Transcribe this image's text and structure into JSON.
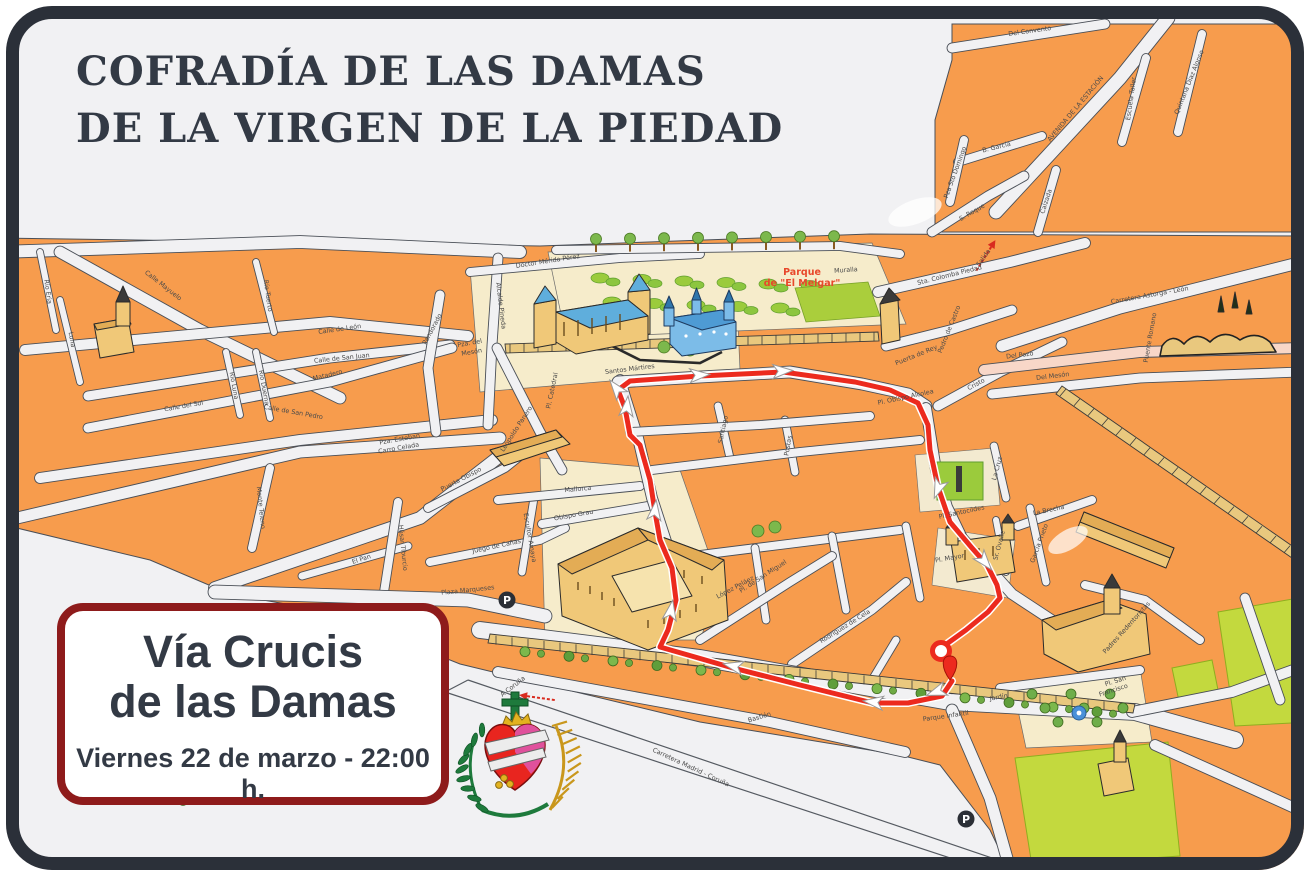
{
  "poster": {
    "title": {
      "line1": "COFRADÍA DE LAS DAMAS",
      "line2": "DE LA VIRGEN DE LA PIEDAD"
    },
    "event_box": {
      "name_line1": "Vía Crucis",
      "name_line2": "de las Damas",
      "datetime": "Viernes 22 de marzo - 22:00 h."
    },
    "colors": {
      "frame": "#2b3039",
      "background": "#f1f1f3",
      "block_orange": "#f79c4d",
      "route_red": "#ec2a1e",
      "box_border_red": "#8e1b1b",
      "title_text": "#333a45",
      "park_green": "#9bcb3c",
      "field_green": "#c3d93e",
      "building_tan": "#f0c878",
      "landmark_blue": "#6fb7e4",
      "wall_tan": "#e9c87e",
      "cream": "#f6eccb"
    }
  },
  "map": {
    "park_label": {
      "line1": "Parque",
      "line2": "de \"El Melgar\"",
      "color": "#e8472b"
    },
    "parking_icons": [
      {
        "x": 507,
        "y": 600
      },
      {
        "x": 966,
        "y": 819
      }
    ],
    "street_labels": [
      {
        "t": "Calle Mayuelo",
        "x": 162,
        "y": 287,
        "r": 38
      },
      {
        "t": "Río Eria",
        "x": 46,
        "y": 292,
        "r": 82
      },
      {
        "t": "Luna",
        "x": 70,
        "y": 340,
        "r": 80
      },
      {
        "t": "Río Tuerto",
        "x": 266,
        "y": 296,
        "r": 82
      },
      {
        "t": "Río Luna",
        "x": 232,
        "y": 386,
        "r": 80
      },
      {
        "t": "Río Duerna",
        "x": 262,
        "y": 388,
        "r": 80
      },
      {
        "t": "Calle de León",
        "x": 340,
        "y": 331,
        "r": -8
      },
      {
        "t": "Calle de San Juan",
        "x": 342,
        "y": 360,
        "r": -6
      },
      {
        "t": "Matadero",
        "x": 328,
        "y": 377,
        "r": -14
      },
      {
        "t": "Calle del Sol",
        "x": 184,
        "y": 408,
        "r": -10
      },
      {
        "t": "Calle de San Pedro",
        "x": 293,
        "y": 414,
        "r": 10
      },
      {
        "t": "Monte Teleno",
        "x": 259,
        "y": 508,
        "r": 84
      },
      {
        "t": "El Pan",
        "x": 362,
        "y": 561,
        "r": -18
      },
      {
        "t": "Húsar Tiburcio",
        "x": 401,
        "y": 548,
        "r": 84
      },
      {
        "t": "Pandorado",
        "x": 434,
        "y": 330,
        "r": -62
      },
      {
        "t": "Pza. del",
        "x": 470,
        "y": 345,
        "r": -10
      },
      {
        "t": "Mesón",
        "x": 472,
        "y": 354,
        "r": -10
      },
      {
        "t": "Pza. Esteban",
        "x": 400,
        "y": 441,
        "r": -10
      },
      {
        "t": "Carro Celada",
        "x": 399,
        "y": 450,
        "r": -10
      },
      {
        "t": "Alcalde Pineda",
        "x": 499,
        "y": 306,
        "r": 83
      },
      {
        "t": "Leopoldo Panero",
        "x": 518,
        "y": 430,
        "r": -57
      },
      {
        "t": "Puerta Obispo",
        "x": 462,
        "y": 481,
        "r": -28
      },
      {
        "t": "Juego de Cañas",
        "x": 497,
        "y": 548,
        "r": -12
      },
      {
        "t": "Escultor Amaya",
        "x": 528,
        "y": 538,
        "r": 80
      },
      {
        "t": "Plaza Marqueses",
        "x": 468,
        "y": 592,
        "r": -6
      },
      {
        "t": "Obispo Grau",
        "x": 574,
        "y": 517,
        "r": -10
      },
      {
        "t": "Mallorca",
        "x": 578,
        "y": 491,
        "r": -5
      },
      {
        "t": "Pl. Catedral",
        "x": 554,
        "y": 391,
        "r": -78
      },
      {
        "t": "Doctor Mérida Pérez",
        "x": 548,
        "y": 263,
        "r": -9
      },
      {
        "t": "Santos Mártires",
        "x": 630,
        "y": 371,
        "r": -7
      },
      {
        "t": "Santiago",
        "x": 725,
        "y": 430,
        "r": -78
      },
      {
        "t": "Postas",
        "x": 790,
        "y": 446,
        "r": -80
      },
      {
        "t": "Pl. Obispo Alcolea",
        "x": 906,
        "y": 399,
        "r": -12
      },
      {
        "t": "Pedro de Castro",
        "x": 951,
        "y": 330,
        "r": -68
      },
      {
        "t": "Puerta de Rey",
        "x": 917,
        "y": 357,
        "r": -22
      },
      {
        "t": "Cristo",
        "x": 977,
        "y": 386,
        "r": -28
      },
      {
        "t": "Muralla",
        "x": 846,
        "y": 272,
        "r": -4
      },
      {
        "t": "Sta. Colomba Piedad",
        "x": 950,
        "y": 277,
        "r": -14
      },
      {
        "t": "Salida",
        "x": 985,
        "y": 259,
        "r": -55,
        "c": "#d92b1f"
      },
      {
        "t": "Del Convento",
        "x": 1030,
        "y": 33,
        "r": -8
      },
      {
        "t": "AVENIDA DE LA ESTACIÓN",
        "x": 1077,
        "y": 110,
        "r": -50,
        "s": 6
      },
      {
        "t": "Escuela Taller",
        "x": 1133,
        "y": 99,
        "r": -82
      },
      {
        "t": "Quintana Díaz Alonso",
        "x": 1191,
        "y": 83,
        "r": -68
      },
      {
        "t": "B. García",
        "x": 997,
        "y": 149,
        "r": -14
      },
      {
        "t": "Pza Sto Domingo",
        "x": 957,
        "y": 173,
        "r": -70
      },
      {
        "t": "S. Roque",
        "x": 973,
        "y": 214,
        "r": -30
      },
      {
        "t": "Calzada",
        "x": 1048,
        "y": 202,
        "r": -72
      },
      {
        "t": "Carretera Astorga - León",
        "x": 1150,
        "y": 297,
        "r": -10
      },
      {
        "t": "Puente Romano",
        "x": 1152,
        "y": 338,
        "r": -80
      },
      {
        "t": "Del Pozo",
        "x": 1020,
        "y": 357,
        "r": -7
      },
      {
        "t": "Del Mesón",
        "x": 1053,
        "y": 378,
        "r": -7
      },
      {
        "t": "Pl. Santocildes",
        "x": 962,
        "y": 514,
        "r": -12
      },
      {
        "t": "Pl. Mayor",
        "x": 950,
        "y": 560,
        "r": -10
      },
      {
        "t": "La Cruz",
        "x": 999,
        "y": 469,
        "r": -75
      },
      {
        "t": "La Brecha",
        "x": 1049,
        "y": 512,
        "r": -12
      },
      {
        "t": "García Prieto",
        "x": 1041,
        "y": 544,
        "r": -70
      },
      {
        "t": "Sr. Ovalle",
        "x": 1001,
        "y": 546,
        "r": -75
      },
      {
        "t": "López Peláez",
        "x": 736,
        "y": 589,
        "r": -28
      },
      {
        "t": "Rodríguez de Cela",
        "x": 846,
        "y": 628,
        "r": -32
      },
      {
        "t": "Pl. de San Miguel",
        "x": 764,
        "y": 578,
        "r": -33
      },
      {
        "t": "Bastión",
        "x": 760,
        "y": 719,
        "r": -17
      },
      {
        "t": "Carretera Madrid - Coruña",
        "x": 690,
        "y": 769,
        "r": 25
      },
      {
        "t": "A Coruña",
        "x": 514,
        "y": 688,
        "r": -38
      },
      {
        "t": "Jardín",
        "x": 999,
        "y": 699,
        "r": -10
      },
      {
        "t": "Pl. San",
        "x": 1116,
        "y": 683,
        "r": -18
      },
      {
        "t": "Francisco",
        "x": 1114,
        "y": 692,
        "r": -18
      },
      {
        "t": "Padres Redentoristas",
        "x": 1128,
        "y": 629,
        "r": -48
      },
      {
        "t": "Parque Infantil",
        "x": 946,
        "y": 718,
        "r": -8
      }
    ],
    "route": {
      "color": "#ec2a1e",
      "points": [
        [
          952,
          681
        ],
        [
          942,
          696
        ],
        [
          908,
          703
        ],
        [
          873,
          703
        ],
        [
          800,
          685
        ],
        [
          733,
          668
        ],
        [
          688,
          655
        ],
        [
          660,
          647
        ],
        [
          668,
          630
        ],
        [
          676,
          600
        ],
        [
          672,
          568
        ],
        [
          660,
          540
        ],
        [
          655,
          512
        ],
        [
          650,
          480
        ],
        [
          640,
          445
        ],
        [
          630,
          435
        ],
        [
          625,
          408
        ],
        [
          618,
          390
        ],
        [
          630,
          381
        ],
        [
          700,
          376
        ],
        [
          783,
          372
        ],
        [
          855,
          382
        ],
        [
          890,
          390
        ],
        [
          918,
          403
        ],
        [
          928,
          425
        ],
        [
          930,
          450
        ],
        [
          938,
          487
        ],
        [
          950,
          522
        ],
        [
          972,
          548
        ],
        [
          987,
          565
        ],
        [
          997,
          585
        ],
        [
          1000,
          598
        ],
        [
          988,
          612
        ],
        [
          966,
          630
        ],
        [
          948,
          643
        ],
        [
          941,
          651
        ]
      ],
      "arrows": [
        {
          "x": 733,
          "y": 666,
          "a": 193
        },
        {
          "x": 873,
          "y": 702,
          "a": 187
        },
        {
          "x": 936,
          "y": 692,
          "a": 160
        },
        {
          "x": 671,
          "y": 610,
          "a": -80
        },
        {
          "x": 655,
          "y": 510,
          "a": -83
        },
        {
          "x": 627,
          "y": 406,
          "a": -84
        },
        {
          "x": 616,
          "y": 388,
          "a": -128
        },
        {
          "x": 700,
          "y": 375,
          "a": -4
        },
        {
          "x": 783,
          "y": 371,
          "a": -3
        },
        {
          "x": 938,
          "y": 489,
          "a": 112
        },
        {
          "x": 985,
          "y": 562,
          "a": 50
        }
      ],
      "start_marker": {
        "x": 941,
        "y": 651
      },
      "pin_marker": {
        "x": 950,
        "y": 664
      }
    },
    "direction_arrows_red": [
      {
        "x": 533,
        "y": 697,
        "a": 188
      },
      {
        "x": 988,
        "y": 252,
        "a": -58
      }
    ]
  }
}
